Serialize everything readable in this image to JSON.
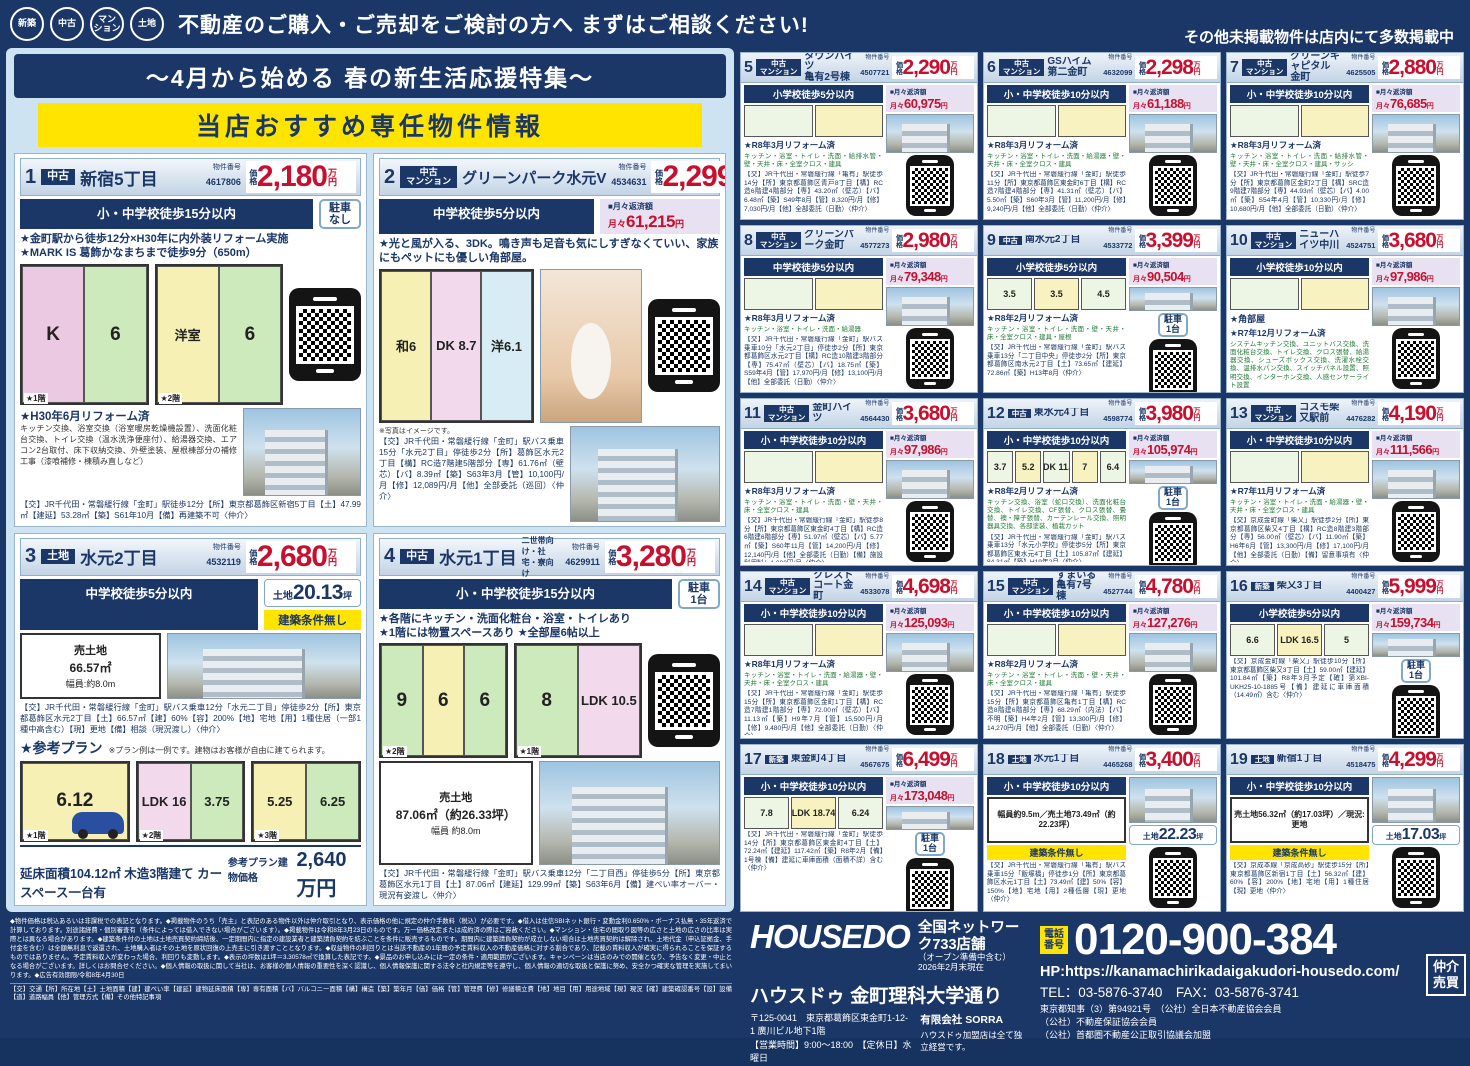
{
  "header": {
    "badges": [
      "新築",
      "中古",
      "マン\nション",
      "土地"
    ],
    "headline": "不動産のご購入・ご売却をご検討の方へ まずはご相談ください!",
    "right_note": "その他未掲載物件は店内にて多数掲載中"
  },
  "left_panel": {
    "title": "〜4月から始める 春の新生活応援特集〜",
    "banner": "当店おすすめ専任物件情報"
  },
  "labels": {
    "bukken": "物件番号",
    "price_prefix": "価格",
    "price_unit": "万円",
    "monthly_label": "■月々返済額",
    "monthly_prefix": "月々",
    "yen": "円",
    "land_prefix": "土地",
    "tsubo": "坪"
  },
  "featured": [
    {
      "no": "1",
      "type": "中古",
      "name": "新宿5丁目",
      "bukken": "4617806",
      "price": "2,180",
      "school": "小・中学校徒歩15分以内",
      "parking": "駐車\nなし",
      "points": "★金町駅から徒歩12分×H30年に内外装リフォーム実施\n★MARK IS 葛飾かなまちまで徒歩9分（650m）",
      "p1r1": "K",
      "p1r2": "6",
      "p1f": "★1階",
      "p2r1": "洋室",
      "p2r2": "6",
      "p2f": "★2階",
      "reform_title": "★H30年6月リフォーム済",
      "reform_text": "キッチン交換、浴室交換（浴室暖房乾燥機設置）、洗面化粧台交換、トイレ交換（温水洗浄便座付）、給湯器交換、エアコン2台取付、床下収納交換、外壁塗装、屋根棟部分の補修工事（漆喰補修・棟積み直しなど）",
      "desc": "【交】JR千代田・常磐緩行線「金町」駅徒歩12分【所】東京都葛飾区新宿5丁目【土】47.99㎡【建延】53.28㎡【築】S61年10月【備】再建築不可〈仲介〉"
    },
    {
      "no": "2",
      "type": "中古\nマンション",
      "name": "グリーンパーク水元V",
      "bukken": "4534631",
      "price": "2,299",
      "school": "中学校徒歩5分以内",
      "monthly": "61,215",
      "points": "★光と風が入る、3DK。鳴き声も足音も気にしすぎなくていい、家族にもペットにも優しい角部屋。",
      "p1r1": "和6",
      "p1r2": "DK 8.7",
      "p1r3": "洋6.1",
      "photo_note": "※写真はイメージです。",
      "desc": "【交】JR千代田・常磐緩行線「金町」駅バス乗車15分「水元2丁目」停徒歩2分【所】葛飾区水元2丁目【構】RC造7階建5階部分【専】61.76㎡（壁芯）【バ】8.39㎡【築】S63年3月【管】10,100円/月【修】12,089円/月【他】全部委託（巡回）〈仲介〉"
    },
    {
      "no": "3",
      "type": "土地",
      "name": "水元2丁目",
      "bukken": "4532119",
      "price": "2,680",
      "school": "中学校徒歩5分以内",
      "land_tsubo": "20.13",
      "land_note": "建築条件無し",
      "land_info1": "売土地",
      "land_info2": "66.57㎡",
      "land_width": "幅員:約8.0m",
      "desc": "【交】JR千代田・常磐緩行線「金町」駅バス乗車12分「水元二丁目」停徒歩2分【所】東京都葛飾区水元2丁目【土】66.57㎡【建】60%【容】200%【地】宅地【用】1種住居（一部1種中高含む）【現】更地【備】相談（現況渡し）〈仲介〉",
      "plan_title": "★参考プラン",
      "plan_note": "※プラン例は一例です。建物はお客様が自由に建てられます。",
      "p1r1": "6.12",
      "p1f": "★1階",
      "p2r1": "LDK 16",
      "p2r2": "3.75",
      "p2f": "★2階",
      "p3r1": "5.25",
      "p3r2": "6.25",
      "p3f": "★3階",
      "plan_footer": "延床面積104.12㎡ 木造3階建て カースペース一台有",
      "ref_label": "参考プラン建物価格",
      "ref_price": "2,640万円"
    },
    {
      "no": "4",
      "type": "中古",
      "name": "水元1丁目",
      "subtitle": "二世帯向け・社宅・寮向け",
      "bukken": "4629911",
      "price": "3,280",
      "school": "小・中学校徒歩15分以内",
      "parking": "駐車\n1台",
      "points": "★各階にキッチン・洗面化粧台・浴室・トイレあり\n★1階には物置スペースあり ★全部屋6帖以上",
      "p1r1": "9",
      "p1r2": "6",
      "p1r3": "6",
      "p1f": "★2階",
      "p2r1": "8",
      "p2r2": "LDK 10.5",
      "p2f": "★1階",
      "land_info1": "売土地",
      "land_info2": "87.06㎡（約26.33坪）",
      "land_width": "幅員 約8.0m",
      "desc": "【交】JR千代田・常磐緩行線「金町」駅バス乗車12分「二丁目西」停徒歩5分【所】東京都葛飾区水元1丁目【土】87.06㎡【建延】129.99㎡【築】S63年6月【備】建ぺい率オーバー・現況有姿渡し〈仲介〉"
    }
  ],
  "listings": [
    {
      "no": "5",
      "type": "中古\nマンション",
      "name": "タウンハイツ\n亀有2号棟",
      "bukken": "4507721",
      "price": "2,290",
      "school": "小学校徒歩5分以内",
      "monthly": "60,975",
      "reform_title": "★R8年3月リフォーム済",
      "reform_text": "キッチン・浴室・トイレ・洗面・給排水管・壁・天井・床・全室クロス・建具",
      "desc": "【交】JR千代田・常磐緩行線「亀有」駅徒歩14分【所】東京都葛飾区青戸8丁目【構】RC造6階建4階部分【専】43.20㎡（壁芯）【バ】6.48㎡【築】S49年8月【管】8,320円/月【修】7,030円/月【他】全部委託（日勤）〈仲介〉"
    },
    {
      "no": "6",
      "type": "中古\nマンション",
      "name": "GSハイム第二金町",
      "bukken": "4632099",
      "price": "2,298",
      "school": "小・中学校徒歩10分以内",
      "monthly": "61,188",
      "reform_title": "★R8年3月リフォーム済",
      "reform_text": "キッチン・浴室・トイレ・洗面・給湯器・壁・天井・床・全室クロス・建具",
      "desc": "【交】JR千代田・常磐緩行線「金町」駅徒歩11分【所】東京都葛飾区東金町6丁目【構】RC造7階建4階部分【専】41.31㎡（壁芯）【バ】5.50㎡【築】S60年3月【管】11,200円/月【修】9,240円/月【他】全部委託（日勤）〈仲介〉"
    },
    {
      "no": "7",
      "type": "中古\nマンション",
      "name": "グリーンキャピタル\n金町",
      "bukken": "4625505",
      "price": "2,880",
      "school": "小・中学校徒歩10分以内",
      "monthly": "76,685",
      "reform_title": "★R8年3月リフォーム済",
      "reform_text": "キッチン・浴室・トイレ・洗面・給排水管・壁・天井・床・全室クロス・建具・サッシ",
      "desc": "【交】JR千代田・常磐緩行線「金町」駅徒歩7分【所】東京都葛飾区金町2丁目【構】SRC造9階建7階部分【専】44.93㎡（壁芯）【バ】4.00㎡【築】S54年4月【管】10,330円/月【修】10,680円/月【他】全部委託（日勤）〈仲介〉"
    },
    {
      "no": "8",
      "type": "中古\nマンション",
      "name": "グリーンパーク金町",
      "bukken": "4577273",
      "price": "2,980",
      "school": "中学校徒歩5分以内",
      "monthly": "79,348",
      "reform_title": "★R8年3月リフォーム済",
      "reform_text": "キッチン・浴室・トイレ・洗面・給湯器",
      "desc": "【交】JR千代田・常磐緩行線「金町」駅バス乗車10分「水元2丁目」停徒歩2分【所】東京都葛飾区水元2丁目【構】RC造10階建3階部分【専】75.47㎡（壁芯）【バ】18.75㎡【築】S59年4月【管】17,970円/月【修】13,100円/月【他】全部委託（日勤）〈仲介〉"
    },
    {
      "no": "9",
      "type": "中古",
      "name": "南水元2丁目",
      "bukken": "4533772",
      "price": "3,399",
      "school": "小学校徒歩5分以内",
      "monthly": "90,504",
      "parking": "駐車\n1台",
      "plan_rooms": [
        "3.5",
        "3.5",
        "4.5"
      ],
      "reform_title": "★R8年2月リフォーム済",
      "reform_text": "キッチン・浴室・トイレ・洗面・壁・天井・床・全室クロス・建具・屋根",
      "desc": "【交】JR千代田・常磐緩行線「金町」駅バス乗車13分「二丁目中央」停徒歩2分【所】東京都葛飾区南水元2丁目【土】73.65㎡【建延】72.86㎡【築】H13年8月〈仲介〉"
    },
    {
      "no": "10",
      "type": "中古\nマンション",
      "name": "ニューハイツ中川",
      "bukken": "4524751",
      "price": "3,680",
      "school": "小学校徒歩10分以内",
      "monthly": "97,986",
      "corner": "★角部屋",
      "reform_title": "★R7年12月リフォーム済",
      "reform_text": "システムキッチン交換、ユニットバス交換、洗面化粧台交換、トイレ交換、クロス張替、給湯器交換、シューズボックス交換、洗濯水栓交換、温排水パン交換、スイッチパネル設置、照明交換、インターホン交換、人感センサーライト設置",
      "desc": "【交】JR千代田・常磐緩行線「亀有」駅徒歩10分【所】東京都葛飾区亀有2丁目【構】SRC造10階建5階部分【専】61.57㎡（壁芯）【バ】不詳【築】S53年3月【管】7,000円/月【修】16,000円/月【他】一部管理（巡回）〈仲介〉"
    },
    {
      "no": "11",
      "type": "中古\nマンション",
      "name": "金町ハイツ",
      "bukken": "4564430",
      "price": "3,680",
      "school": "小・中学校徒歩10分以内",
      "monthly": "97,986",
      "reform_title": "★R8年3月リフォーム済",
      "reform_text": "キッチン・浴室・トイレ・洗面・壁・天井・床・全室クロス・建具",
      "desc": "【交】JR千代田・常磐緩行線「金町」駅徒歩8分【所】東京都葛飾区東金町4丁目【構】RC造6階建6階部分【専】51.97㎡（壁芯）【バ】5.77㎡【築】S60年11月【管】14,200円/月【修】12,140円/月【他】全部委託（日勤）【備】施設利用料：1,000円/月〈仲介〉"
    },
    {
      "no": "12",
      "type": "中古",
      "name": "東水元4丁目",
      "bukken": "4598774",
      "price": "3,980",
      "school": "小・中学校徒歩10分以内",
      "monthly": "105,974",
      "parking": "駐車\n1台",
      "plan_rooms": [
        "3.7",
        "5.2",
        "LDK 11.1",
        "7",
        "6.4"
      ],
      "reform_title": "★R8年2月リフォーム済",
      "reform_text": "キッチン交換、浴室（蛇口交換）、洗面化粧台交換、トイレ交換、CF張替、クロス張替、畳替、襖・障子張替、カーテンレール交換、照明器具交換、各部塗装、植栽カット",
      "desc": "【交】JR千代田・常磐緩行線「金町」駅バス乗車13分「水元小学校」停徒歩5分【所】東京都葛飾区東水元4丁目【土】105.87㎡【建延】84.31㎡【築】H19年2月〈仲介〉"
    },
    {
      "no": "13",
      "type": "中古\nマンション",
      "name": "コスモ柴又駅前",
      "bukken": "4476282",
      "price": "4,190",
      "school": "小・中学校徒歩10分以内",
      "monthly": "111,566",
      "reform_title": "★R7年11月リフォーム済",
      "reform_text": "キッチン・浴室・トイレ・洗面・給湯器・壁・天井・床・全室クロス・建具",
      "desc": "【交】京成金町線「柴又」駅徒歩2分【所】東京都葛飾区柴又4丁目【構】RC造8階建3階部分【専】56.00㎡（壁芯）【バ】11.90㎡【築】H6年6月【管】13,300円/月【修】17,100円/月【他】全部委託（日勤）【備】留意事項有〈仲介〉"
    },
    {
      "no": "14",
      "type": "中古\nマンション",
      "name": "クレストコート金町",
      "bukken": "4533078",
      "price": "4,698",
      "school": "小・中学校徒歩10分以内",
      "monthly": "125,093",
      "reform_title": "★R8年1月リフォーム済",
      "reform_text": "キッチン・浴室・トイレ・洗面・給湯器・壁・天井・床・全室クロス・建具",
      "desc": "【交】JR千代田・常磐緩行線「金町」駅徒歩15分【所】東京都葛飾区金町1丁目【構】RC造7階建1階部分【専】72.00㎡（壁芯）【バ】11.13㎡【築】H9年7月【管】15,500円/月【修】9,480円/月【他】全部委託（日勤）〈仲介〉"
    },
    {
      "no": "15",
      "type": "中古\nマンション",
      "name": "すまいる亀有7号棟",
      "bukken": "4527744",
      "price": "4,780",
      "school": "小・中学校徒歩10分以内",
      "monthly": "127,276",
      "reform_title": "★R8年2月リフォーム済",
      "reform_text": "キッチン・浴室・トイレ・洗面・壁・天井・床・全室クロス・建具",
      "desc": "【交】JR千代田・常磐緩行線「亀有」駅徒歩15分【所】東京都葛飾区亀有1丁目【構】RC造8階建6階部分【専】68.29㎡（内法）【バ】不明【築】H4年2月【管】13,300円/月【修】14,270円/月【他】全部委託（日勤）〈仲介〉"
    },
    {
      "no": "16",
      "type": "新築",
      "name": "柴又3丁目",
      "bukken": "4400427",
      "price": "5,999",
      "school": "小学校徒歩5分以内",
      "monthly": "159,734",
      "parking": "駐車\n1台",
      "plan_rooms": [
        "6.6",
        "LDK 16.5",
        "5"
      ],
      "desc": "【交】京成金町線「柴又」駅徒歩10分【所】東京都葛飾区柴又3丁目【土】59.00㎡【建延】101.84㎡【築】R8年3月予定【確】第XBI-UKH25-10-1885号【備】建延に車庫面積（14.49㎡）含む〈仲介〉"
    },
    {
      "no": "17",
      "type": "新築",
      "name": "東金町4丁目",
      "bukken": "4567675",
      "price": "6,499",
      "school": "小・中学校徒歩10分以内",
      "monthly": "173,048",
      "parking": "駐車\n1台",
      "plan_rooms": [
        "7.8",
        "LDK 18.74",
        "6.24"
      ],
      "desc": "【交】JR千代田・常磐緩行線「金町」駅徒歩14分【所】東京都葛飾区東金町4丁目【土】72.24㎡【建延】117.42㎡【築】R8年2月【備】1号棟【備】建延に車庫面積（面積不詳）含む〈仲介〉"
    },
    {
      "no": "18",
      "type": "土地",
      "name": "水元1丁目",
      "bukken": "4465268",
      "price": "3,400",
      "school": "小・中学校徒歩10分以内",
      "land_tsubo": "22.23",
      "land_note": "建築条件無し",
      "land_info": "幅員約9.5m／売土地73.49㎡（約22.23坪）",
      "desc": "【交】JR千代田・常磐緩行線「亀有」駅バス乗車15分「飯塚橋」停徒歩1分【所】東京都葛飾区水元1丁目【土】73.49㎡【建】50%【容】150%【地】宅地【用】2種低層【現】更地〈仲介〉"
    },
    {
      "no": "19",
      "type": "土地",
      "name": "新宿1丁目",
      "bukken": "4518475",
      "price": "4,299",
      "school": "小・中学校徒歩10分以内",
      "land_tsubo": "17.03",
      "land_note": "建築条件無し",
      "land_info": "売土地56.32㎡（約17.03坪）／現況:更地",
      "desc": "【交】京成本線「京成高砂」駅徒歩15分【所】東京都葛飾区新宿1丁目【土】56.32㎡【建】60%【容】200%【地】宅地【用】1種住居【現】更地〈仲介〉"
    }
  ],
  "footer": {
    "disclaimer": "◆物件価格は税込あるいは非課税での表記となります。◆掲載物件のうち「売主」と表記のある物件以外は仲介取引となり、表示価格の他に規定の仲介手数料（税込）が必要です。◆借入は住信SBIネット銀行・変動金利0.650%・ボーナス払無・35年返済で計算しております。別途諸経費・個別審査有（条件によっては借入できない場合がございます）。◆掲載物件は令和8年3月23日のものです。万一価格改定または成約済の際はご容赦ください。◆マンション・住宅の間取り図等の広さと土地の広さの比率は実際とは異なる場合があります。◆建築条件付の土地は土地売買契約締結後、一定期間内に指定の建設業者と建築請負契約を結ぶことを条件に販売するものです。期間内に建築請負契約が成立しない場合は土地売買契約は解除され、土地代金（申込証拠金、手付金を含む）は全額無利息で返還され、土地購入者はその土地を原状回復の上売主に引き渡すこととなります。◆収益物件の利回りとは当該不動産の1年間の予定賃料収入の不動産価格に対する割合であり、記載の賃料収入が確実に得られることを保証するものではありません。予定賃料収入が変わった場合、利回りも変動します。◆表示の坪数は1坪＝3.30578㎡で換算した表記です。◆景品のお申し込みには一定の条件・適用範囲がございます。キャンペーンは当店のみでの開催となり、予告なく変更・中止となる場合がございます。詳しくはお問合せください。◆個人情報の取扱に関して当社は、お客様の個人情報の重要性を深く認識し、個人情報保護に関する法令と社内規定等を遵守し、個人情報の適切な取扱と保護に努め、安全かつ確実な管理を実施してまいります。◆広告有効期限/令和8年4月30日",
    "legend": "【交】交通【所】所在地【土】土地面積【建】建ぺい率【建延】建物延床面積【専】専有面積【バ】バルコニー面積【構】構造【築】築年月【価】価格【管】管理費【修】修繕積立費【地】地目【用】用途地域【現】現況【確】建築確認番号【設】設備【道】道路幅員【他】管理方式【備】その他特記事項",
    "brand": {
      "logo": "HOUSEDO",
      "network": "全国ネットワーク733店舗",
      "network_note": "（オープン準備中含む）2026年2月末現在",
      "store": "ハウスドゥ 金町理科大学通り",
      "address": "〒125-0041　東京都葛飾区東金町1-12-1 廣川ビル地下1階",
      "hours": "【営業時間】9:00〜18:00　【定休日】水曜日",
      "company": "有限会社 SORRA",
      "company_note": "ハウスドゥ加盟店は全て独立経営です。"
    },
    "contact": {
      "phone_label": "電話\n番号",
      "phone": "0120-900-384",
      "hp": "HP:https://kanamachirikadaigakudori-housedo.com/",
      "tel_fax": "TEL：03-5876-3740　FAX：03-5876-3741",
      "license1": "東京都知事（3）第94921号　（公社）全日本不動産協会会員",
      "license2": "（公社）不動産保証協会会員",
      "license3": "（公社）首都圏不動産公正取引協議会加盟",
      "side_badge": "仲介\n売買"
    }
  }
}
